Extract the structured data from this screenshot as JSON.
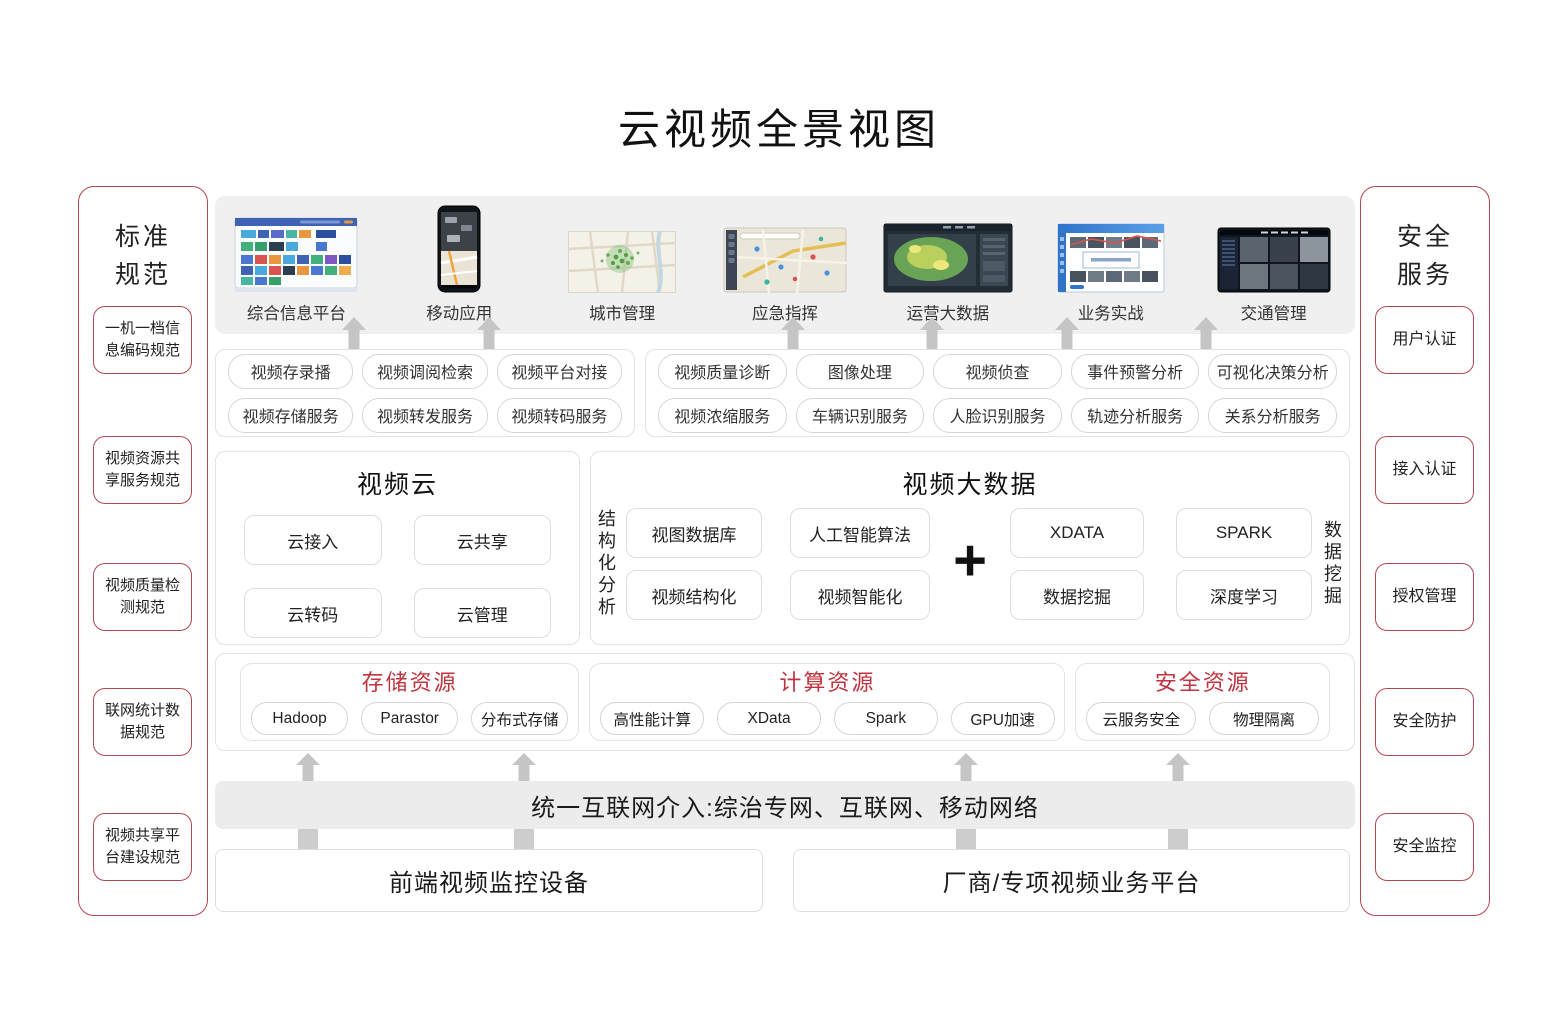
{
  "title": "云视频全景视图",
  "left_sidebar": {
    "title": "标准\n规范",
    "items": [
      "一机一档信息编码规范",
      "视频资源共享服务规范",
      "视频质量检测规范",
      "联网统计数据规范",
      "视频共享平台建设规范"
    ]
  },
  "right_sidebar": {
    "title": "安全\n服务",
    "items": [
      "用户认证",
      "接入认证",
      "授权管理",
      "安全防护",
      "安全监控"
    ]
  },
  "apps": [
    {
      "label": "综合信息平台"
    },
    {
      "label": "移动应用"
    },
    {
      "label": "城市管理"
    },
    {
      "label": "应急指挥"
    },
    {
      "label": "运营大数据"
    },
    {
      "label": "业务实战"
    },
    {
      "label": "交通管理"
    }
  ],
  "services_left": {
    "rows": [
      [
        "视频存录播",
        "视频调阅检索",
        "视频平台对接"
      ],
      [
        "视频存储服务",
        "视频转发服务",
        "视频转码服务"
      ]
    ]
  },
  "services_right": {
    "rows": [
      [
        "视频质量诊断",
        "图像处理",
        "视频侦查",
        "事件预警分析",
        "可视化决策分析"
      ],
      [
        "视频浓缩服务",
        "车辆识别服务",
        "人脸识别服务",
        "轨迹分析服务",
        "关系分析服务"
      ]
    ]
  },
  "video_cloud": {
    "title": "视频云",
    "buttons": [
      "云接入",
      "云共享",
      "云转码",
      "云管理"
    ]
  },
  "video_bigdata": {
    "title": "视频大数据",
    "left_vertical": "结构化分析",
    "right_vertical": "数据挖掘",
    "plus": "+",
    "left_buttons": [
      [
        "视图数据库",
        "人工智能算法"
      ],
      [
        "视频结构化",
        "视频智能化"
      ]
    ],
    "right_buttons": [
      [
        "XDATA",
        "SPARK"
      ],
      [
        "数据挖掘",
        "深度学习"
      ]
    ]
  },
  "resources": {
    "groups": [
      {
        "title": "存储资源",
        "items": [
          "Hadoop",
          "Parastor",
          "分布式存储"
        ]
      },
      {
        "title": "计算资源",
        "items": [
          "高性能计算",
          "XData",
          "Spark",
          "GPU加速"
        ]
      },
      {
        "title": "安全资源",
        "items": [
          "云服务安全",
          "物理隔离"
        ]
      }
    ]
  },
  "bottom": {
    "bar": "统一互联网介入:综治专网、互联网、移动网络",
    "boxes": [
      "前端视频监控设备",
      "厂商/专项视频业务平台"
    ]
  },
  "colors": {
    "accent_red_border": "#b5454e",
    "resource_title_red": "#c0343f",
    "band_gray": "#f0f0f0",
    "bar_gray": "#ececec",
    "arrow_gray": "#c5c5c5"
  }
}
